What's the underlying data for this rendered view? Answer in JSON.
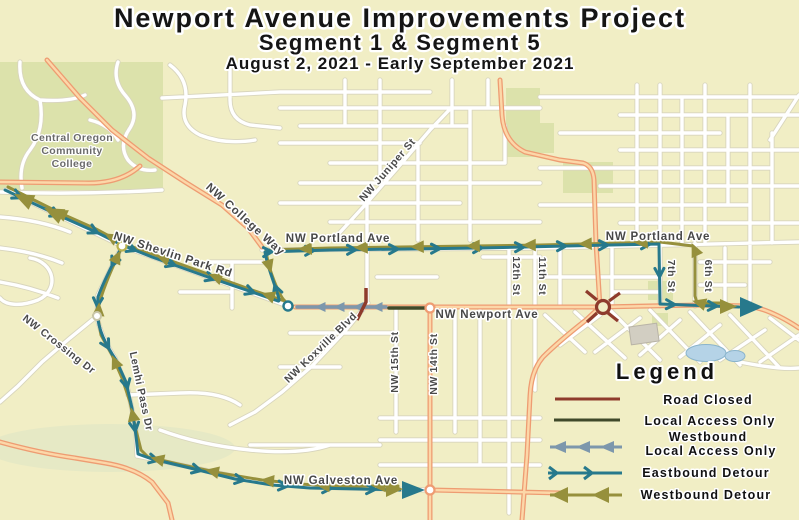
{
  "title": {
    "line1": "Newport Avenue Improvements Project",
    "line2": "Segment 1 & Segment 5",
    "line3": "August 2, 2021 - Early September 2021"
  },
  "legend": {
    "title": "Legend",
    "items": [
      {
        "id": "road-closed",
        "label": "Road Closed",
        "style": "solid-line"
      },
      {
        "id": "local-access-only",
        "label": "Local Access Only",
        "style": "solid-line"
      },
      {
        "id": "westbound-local-access-only",
        "label_line1": "Westbound",
        "label_line2": "Local Access Only",
        "style": "left-arrow-line"
      },
      {
        "id": "eastbound-detour",
        "label": "Eastbound Detour",
        "style": "right-chevron-line"
      },
      {
        "id": "westbound-detour",
        "label": "Westbound Detour",
        "style": "left-arrow-line"
      }
    ]
  },
  "map": {
    "places": {
      "college_line1": "Central Oregon",
      "college_line2": "Community",
      "college_line3": "College"
    },
    "labels": {
      "portland_w": "NW Portland Ave",
      "portland_e": "NW Portland Ave",
      "newport": "NW Newport Ave",
      "galveston": "NW Galveston Ave",
      "college_way": "NW College Way",
      "shevlin": "NW Shevlin Park Rd",
      "juniper": "NW Juniper St",
      "crossing": "NW Crossing Dr",
      "lemhi": "Lemhi Pass Dr",
      "koxville": "NW Koxville Blvd",
      "st15": "NW 15th St",
      "st14": "NW 14th St",
      "st12": "12th St",
      "st11": "11th St",
      "st7": "7th St",
      "st6": "6th St"
    },
    "colors": {
      "background": "#f1eec5",
      "greenspace": "#dce2ab",
      "water": "#b5d3e7",
      "road_closed": "#8e3b2c",
      "local_access": "#40492a",
      "westbound_local_access": "#7d97ac",
      "eastbound_detour": "#27798c",
      "westbound_detour": "#96903c",
      "arterial_casing": "#ee9c72",
      "arterial_fill": "#fcd7a8"
    }
  }
}
